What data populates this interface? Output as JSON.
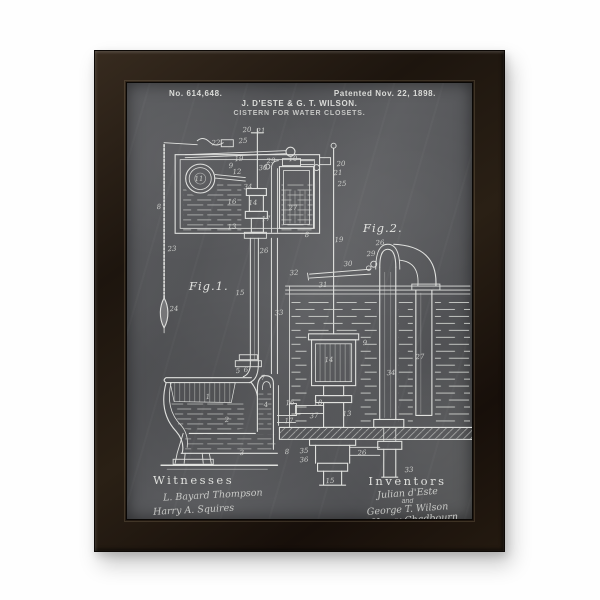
{
  "artwork": {
    "patent_number": "No. 614,648.",
    "patent_date": "Patented Nov. 22, 1898.",
    "inventor_names": "J. D'ESTE & G. T. WILSON.",
    "invention_title": "CISTERN FOR WATER CLOSETS.",
    "figure_labels": {
      "fig1": "Fig.1.",
      "fig2": "Fig.2."
    },
    "witnesses": {
      "heading": "Witnesses",
      "signatures": [
        "L. Bayard Thompson",
        "Harry A. Squires"
      ]
    },
    "inventors": {
      "heading": "Inventors",
      "lines": [
        "Julian d'Este",
        "and",
        "George T. Wilson",
        "by Henry Chadbourn",
        "Atty."
      ]
    },
    "part_labels": [
      {
        "t": "20",
        "x": 120,
        "y": 47
      },
      {
        "t": "21",
        "x": 134,
        "y": 48
      },
      {
        "t": "25",
        "x": 116,
        "y": 58
      },
      {
        "t": "22",
        "x": 89,
        "y": 60
      },
      {
        "t": "11",
        "x": 72,
        "y": 96
      },
      {
        "t": "9",
        "x": 104,
        "y": 83
      },
      {
        "t": "12",
        "x": 110,
        "y": 89
      },
      {
        "t": "19",
        "x": 112,
        "y": 76
      },
      {
        "t": "29",
        "x": 144,
        "y": 78
      },
      {
        "t": "30",
        "x": 136,
        "y": 85
      },
      {
        "t": "10",
        "x": 166,
        "y": 76
      },
      {
        "t": "34",
        "x": 121,
        "y": 104
      },
      {
        "t": "14",
        "x": 126,
        "y": 120
      },
      {
        "t": "16",
        "x": 105,
        "y": 119
      },
      {
        "t": "27",
        "x": 166,
        "y": 125
      },
      {
        "t": "13",
        "x": 105,
        "y": 144
      },
      {
        "t": "17",
        "x": 139,
        "y": 136
      },
      {
        "t": "8",
        "x": 32,
        "y": 124
      },
      {
        "t": "23",
        "x": 45,
        "y": 166
      },
      {
        "t": "24",
        "x": 47,
        "y": 226
      },
      {
        "t": "8",
        "x": 180,
        "y": 152
      },
      {
        "t": "20",
        "x": 214,
        "y": 81
      },
      {
        "t": "21",
        "x": 211,
        "y": 90
      },
      {
        "t": "25",
        "x": 215,
        "y": 101
      },
      {
        "t": "19",
        "x": 212,
        "y": 157
      },
      {
        "t": "15",
        "x": 113,
        "y": 210
      },
      {
        "t": "33",
        "x": 152,
        "y": 230
      },
      {
        "t": "26",
        "x": 137,
        "y": 168
      },
      {
        "t": "26",
        "x": 253,
        "y": 160
      },
      {
        "t": "29",
        "x": 244,
        "y": 171
      },
      {
        "t": "30",
        "x": 221,
        "y": 181
      },
      {
        "t": "32",
        "x": 167,
        "y": 190
      },
      {
        "t": "31",
        "x": 196,
        "y": 202
      },
      {
        "t": "9",
        "x": 238,
        "y": 260
      },
      {
        "t": "27",
        "x": 293,
        "y": 274
      },
      {
        "t": "34",
        "x": 264,
        "y": 290
      },
      {
        "t": "14",
        "x": 202,
        "y": 277
      },
      {
        "t": "5",
        "x": 111,
        "y": 288
      },
      {
        "t": "6",
        "x": 119,
        "y": 287
      },
      {
        "t": "7",
        "x": 136,
        "y": 295
      },
      {
        "t": "1",
        "x": 81,
        "y": 314
      },
      {
        "t": "2",
        "x": 100,
        "y": 337
      },
      {
        "t": "3",
        "x": 115,
        "y": 370
      },
      {
        "t": "4",
        "x": 139,
        "y": 322
      },
      {
        "t": "16",
        "x": 163,
        "y": 320
      },
      {
        "t": "18",
        "x": 191,
        "y": 320
      },
      {
        "t": "37",
        "x": 187,
        "y": 333
      },
      {
        "t": "13",
        "x": 220,
        "y": 331
      },
      {
        "t": "17",
        "x": 162,
        "y": 338
      },
      {
        "t": "8",
        "x": 160,
        "y": 369
      },
      {
        "t": "35",
        "x": 177,
        "y": 368
      },
      {
        "t": "36",
        "x": 177,
        "y": 377
      },
      {
        "t": "26",
        "x": 235,
        "y": 370
      },
      {
        "t": "15",
        "x": 203,
        "y": 398
      },
      {
        "t": "33",
        "x": 282,
        "y": 387
      }
    ],
    "colors": {
      "chalkboard": "#55565a",
      "chalk": "#e8e9e6",
      "frame": "#221a12",
      "wall": "#ffffff"
    }
  }
}
